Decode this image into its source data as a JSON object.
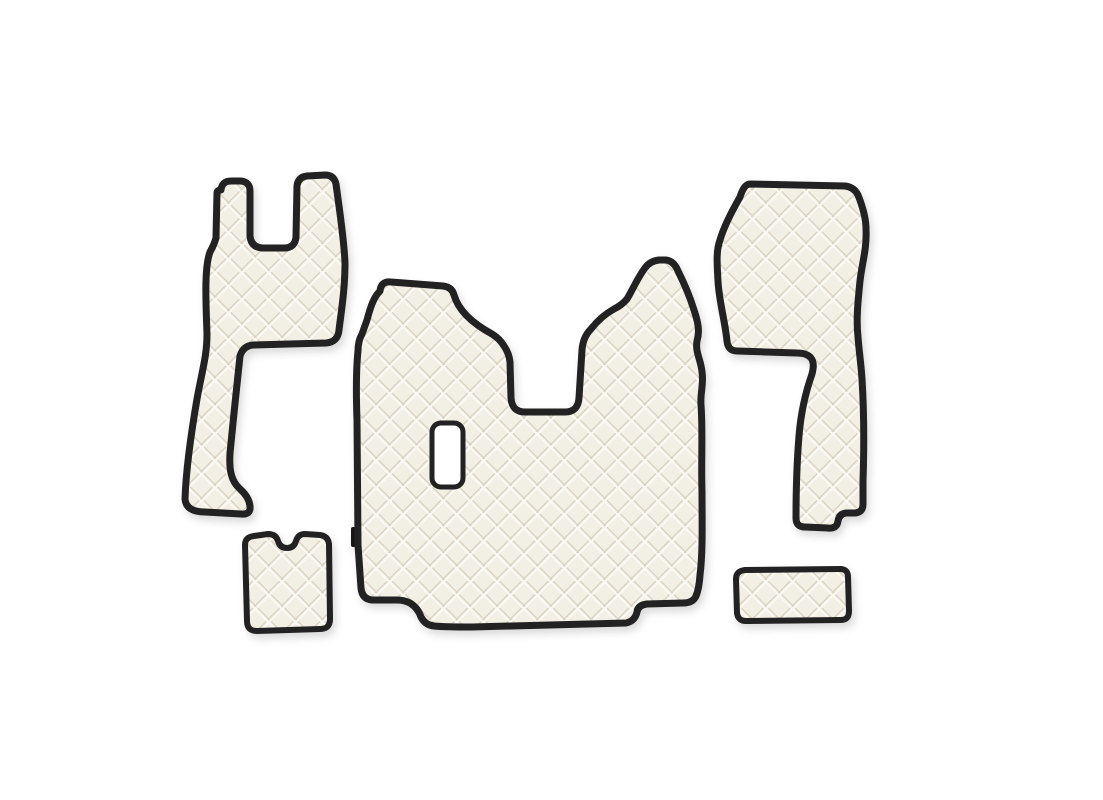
{
  "scene": {
    "type": "product-photo",
    "description": "Five-piece quilted eco-leather truck cab floor mat set in ivory with dark piped edges on a plain white background"
  },
  "colors": {
    "background": "#ffffff",
    "mat_base": "#f2efe5",
    "seam_dark": "#d7d1c0",
    "seam_light": "#fbfaf4",
    "binding": "#212121",
    "tag": "#141414",
    "shadow": "#000000"
  },
  "pieces": [
    {
      "id": "left-floor-mat",
      "role": "tall left mat with two top tabs, U-slot between them and a narrow lower leg with foot step"
    },
    {
      "id": "center-tunnel-mat",
      "role": "large central engine-tunnel mat with raised top-left block, deep U-notch, twin-peak top-right edge, rectangular cutout and stepped bottom edge"
    },
    {
      "id": "right-floor-mat",
      "role": "right mat with wide rounded top block and narrow leg ending in a stepped bottom corner"
    },
    {
      "id": "small-notched-mat",
      "role": "small square mat with a rounded notch in the top edge"
    },
    {
      "id": "small-rectangle-mat",
      "role": "small plain rectangular mat"
    }
  ],
  "details": {
    "brand_tag": {
      "color": "#141414",
      "position": "left edge of center mat"
    },
    "cutout": {
      "shape": "rounded rectangle",
      "location": "center-left of center mat"
    }
  },
  "pattern": {
    "style": "diamond quilting",
    "diamond_pitch_px": 19
  }
}
